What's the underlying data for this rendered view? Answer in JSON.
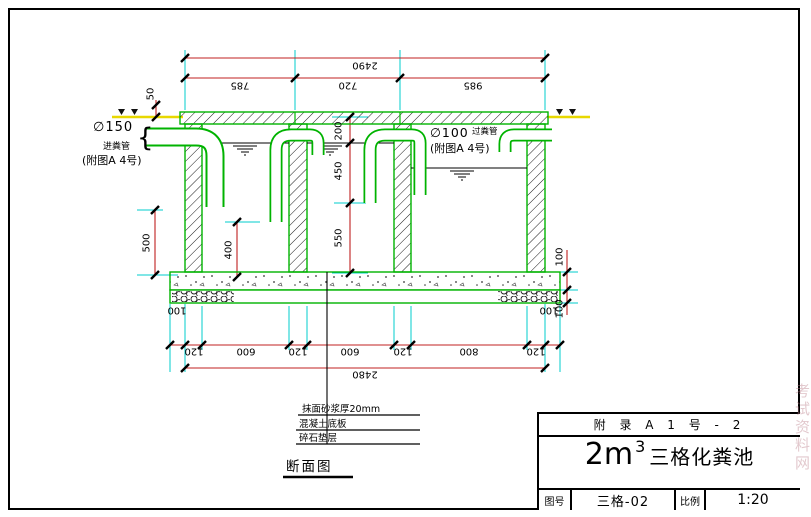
{
  "colors": {
    "structure_green": "#00b300",
    "dimension_red": "#c02020",
    "extension_cyan": "#00cccc",
    "ground_yellow": "#e8d800",
    "line_black": "#000000"
  },
  "drawing": {
    "view_label": "断面图",
    "dims_top": {
      "total": "2490",
      "segments": [
        "785",
        "720",
        "985"
      ]
    },
    "dims_bottom": {
      "total": "2480",
      "chain": [
        "120",
        "600",
        "120",
        "600",
        "120",
        "800",
        "120"
      ],
      "overhang_left": "100",
      "overhang_right": "100"
    },
    "dims_vertical": {
      "chain": [
        "200",
        "450",
        "550"
      ],
      "outer": "500",
      "inner": "400",
      "top": "50",
      "right": [
        "100",
        "100"
      ]
    },
    "inlet": {
      "dia": "∅150",
      "name": "进粪管",
      "ref": "(附图A 4号)",
      "brace": "{"
    },
    "outlet": {
      "dia": "∅100",
      "name": "过粪管",
      "ref": "(附图A 4号)"
    },
    "notes": [
      "抹面砂浆厚20mm",
      "混凝土底板",
      "碎石垫层"
    ]
  },
  "titleblock": {
    "sheet_ref": "附 录 A    1 号 - 2",
    "volume": "2m",
    "volume_exp": "3",
    "title": "三格化粪池",
    "fig_label": "图号",
    "fig_value": "三格-02",
    "scale_label": "比例",
    "scale_value": "1:20"
  },
  "watermark": "考试资料网"
}
